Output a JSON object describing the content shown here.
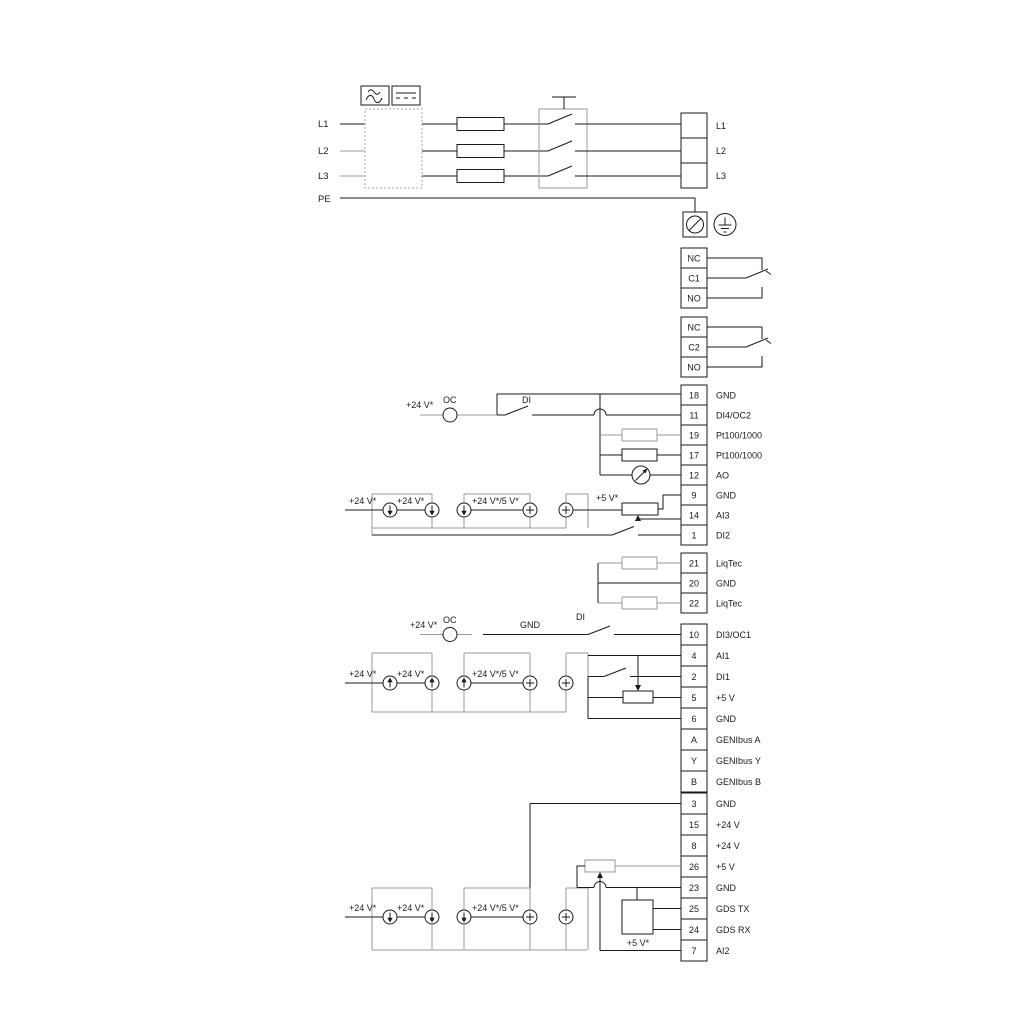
{
  "diagram": {
    "title": "frequency-drive-wiring-diagram",
    "power_in": {
      "lines": [
        "L1",
        "L2",
        "L3",
        "PE"
      ]
    },
    "strips": {
      "power_out": {
        "rows": [
          {
            "num": "",
            "label": "L1"
          },
          {
            "num": "",
            "label": "L2"
          },
          {
            "num": "",
            "label": "L3"
          }
        ]
      },
      "relay1": {
        "rows": [
          {
            "num": "NC",
            "label": ""
          },
          {
            "num": "C1",
            "label": ""
          },
          {
            "num": "NO",
            "label": ""
          }
        ]
      },
      "relay2": {
        "rows": [
          {
            "num": "NC",
            "label": ""
          },
          {
            "num": "C2",
            "label": ""
          },
          {
            "num": "NO",
            "label": ""
          }
        ]
      },
      "strip1": {
        "rows": [
          {
            "num": "18",
            "label": "GND"
          },
          {
            "num": "11",
            "label": "DI4/OC2"
          },
          {
            "num": "19",
            "label": "Pt100/1000"
          },
          {
            "num": "17",
            "label": "Pt100/1000"
          },
          {
            "num": "12",
            "label": "AO"
          },
          {
            "num": "9",
            "label": "GND"
          },
          {
            "num": "14",
            "label": "AI3"
          },
          {
            "num": "1",
            "label": "DI2"
          }
        ]
      },
      "strip2": {
        "rows": [
          {
            "num": "21",
            "label": "LiqTec"
          },
          {
            "num": "20",
            "label": "GND"
          },
          {
            "num": "22",
            "label": "LiqTec"
          }
        ]
      },
      "strip3": {
        "rows": [
          {
            "num": "10",
            "label": "DI3/OC1"
          },
          {
            "num": "4",
            "label": "AI1"
          },
          {
            "num": "2",
            "label": "DI1"
          },
          {
            "num": "5",
            "label": "+5 V"
          },
          {
            "num": "6",
            "label": "GND"
          },
          {
            "num": "A",
            "label": "GENIbus A"
          },
          {
            "num": "Y",
            "label": "GENIbus Y"
          },
          {
            "num": "B",
            "label": "GENIbus B"
          }
        ]
      },
      "strip4": {
        "rows": [
          {
            "num": "3",
            "label": "GND"
          },
          {
            "num": "15",
            "label": "+24 V"
          },
          {
            "num": "8",
            "label": "+24 V"
          },
          {
            "num": "26",
            "label": "+5 V"
          },
          {
            "num": "23",
            "label": "GND"
          },
          {
            "num": "25",
            "label": "GDS TX"
          },
          {
            "num": "24",
            "label": "GDS RX"
          },
          {
            "num": "7",
            "label": "AI2"
          }
        ]
      }
    },
    "annotations": {
      "plus24": "+24 V*",
      "plus24or5": "+24 V*/5 V*",
      "plus5": "+5 V*",
      "oc": "OC",
      "di": "DI",
      "gnd": "GND"
    },
    "colors": {
      "wire": "#1a1a1a",
      "alt_wire": "#9a9a9a",
      "background": "#ffffff"
    }
  }
}
